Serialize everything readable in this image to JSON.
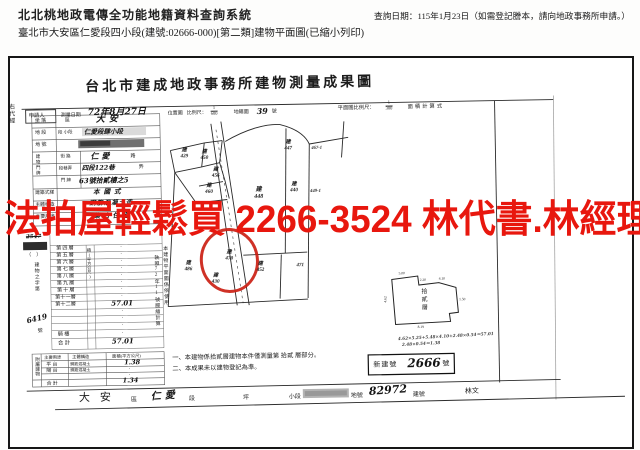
{
  "header": {
    "system_title": "北北桃地政電傳全功能地籍資料查詢系統",
    "query_date": "查詢日期：115年1月23日（如需登記謄本，請向地政事務所申請。）",
    "doc_subtitle": "臺北市大安區仁愛段四小段(建號:02666-000)[第二類]建物平面圖(已縮小列印)"
  },
  "watermark": {
    "text": "法拍屋輕鬆買 2266-3524 林代書.林經理",
    "color": "#e8170e"
  },
  "survey_doc": {
    "title": "台北市建成地政事務所建物測量成果圖",
    "margin_text": "右代經",
    "head": {
      "applicant": "申請人",
      "survey_date_label": "測量日期",
      "survey_date_value": "72年8月27日",
      "location_label": "位置圖",
      "scale_label": "比例尺：",
      "scale_num": "1",
      "scale_den": "600",
      "cadastre_label": "地籍圖",
      "cadastre_no": "39",
      "cadastre_unit": "號",
      "plan_scale_label": "平面圖比例尺：",
      "plan_num": "1",
      "plan_den": "300",
      "area_calc_label": "面積計算式"
    },
    "info": {
      "door_label": "建物門牌",
      "rows": [
        {
          "label": "坐 落",
          "sub": "區",
          "value": "大安",
          "tail": ""
        },
        {
          "label": "地 段",
          "sub": "段 小段",
          "value": "仁愛段肆小段",
          "tail": ""
        },
        {
          "label": "地 號",
          "sub": "",
          "value": "",
          "tail": ""
        },
        {
          "label": "",
          "sub": "街 路",
          "value": "仁愛",
          "tail": "路"
        },
        {
          "label": "",
          "sub": "段巷弄",
          "value": "四段122巷",
          "tail": "弄"
        },
        {
          "label": "",
          "sub": "門 牌",
          "value": "63號拾貳樓之5",
          "tail": ""
        },
        {
          "label": "建築式樣",
          "sub": "",
          "value": "本國式",
          "tail": ""
        },
        {
          "label": "主體構造",
          "sub": "",
          "value": "鋼筋混凝土造",
          "tail": ""
        },
        {
          "label": "主要用途",
          "sub": "",
          "value": "集合住宅",
          "tail": ""
        }
      ]
    },
    "floors": {
      "area_col_header": "積(平方公尺)",
      "names": [
        "第四層",
        "第五層",
        "第六層",
        "第七層",
        "第八層",
        "第九層",
        "第十層",
        "第十一層",
        "第十二層"
      ],
      "values": [
        "·",
        "·",
        "·",
        "·",
        "·",
        "·",
        "·",
        "·",
        "57.01"
      ],
      "blank_values": [
        "·",
        "·",
        "·"
      ],
      "qilou_label": "騎 樓",
      "qilou_value": "·",
      "total_label": "合 計",
      "total_value": "57.01"
    },
    "margin_col": {
      "receipt_no": "2547",
      "paren": "（　）",
      "doc_no_prefix": "建物之字第",
      "doc_no": "6419",
      "doc_no_unit": "號"
    },
    "attached": {
      "title": "附屬建物",
      "col_use": "主要用途",
      "col_structure": "主體構造",
      "col_area": "面積(平方公尺)",
      "rows": [
        {
          "use": "平 台",
          "structure": "鋼筋混凝土",
          "area": "1.38"
        },
        {
          "use": "陽 台",
          "structure": "鋼筋混凝土",
          "area": "·"
        },
        {
          "use": "",
          "structure": "",
          "area": "·"
        }
      ],
      "total_label": "合 計",
      "total_value": "1.34"
    },
    "vertical_note_col1": "本建物平面圖係依使用",
    "vertical_note_col2": "執照72年11號謄繪計算",
    "notes": [
      "一、本建物係拾貳層建物本件僅測量第 拾貳 層部分。",
      "二、本成果未以建物登記為準。"
    ],
    "calc_lines": [
      "4.62×5.25+5.48×4.10+2.48×0.54＝57.01",
      "2.48×0.54＝1.38"
    ],
    "new_building": {
      "label": "新建號",
      "value": "2666",
      "unit": "號"
    },
    "footer": {
      "district": "大安",
      "district_unit": "區",
      "section": "仁愛",
      "section_unit": "段",
      "ping": "坪",
      "subsection_unit": "小段",
      "parcel_label": "地號",
      "parcel_no": "82972",
      "building_label": "建號",
      "signature": "林文"
    },
    "map": {
      "parcels": [
        {
          "prefix": "建",
          "no": "429"
        },
        {
          "prefix": "建",
          "no": "450"
        },
        {
          "prefix": "建",
          "no": "456"
        },
        {
          "prefix": "建",
          "no": "460"
        },
        {
          "prefix": "建",
          "no": "448"
        },
        {
          "prefix": "建",
          "no": "440"
        },
        {
          "prefix": "建",
          "no": "447"
        },
        {
          "prefix": "",
          "no": "467-1"
        },
        {
          "prefix": "",
          "no": "449-1"
        },
        {
          "prefix": "建",
          "no": "486"
        },
        {
          "prefix": "建",
          "no": "470"
        },
        {
          "prefix": "建",
          "no": "430"
        },
        {
          "prefix": "建",
          "no": "452"
        },
        {
          "prefix": "",
          "no": "471"
        }
      ]
    },
    "plan": {
      "label": "拾貳層",
      "dims": [
        "5.00",
        "2.20",
        "4.10",
        "1.50",
        "8.19",
        "4.62"
      ]
    }
  }
}
